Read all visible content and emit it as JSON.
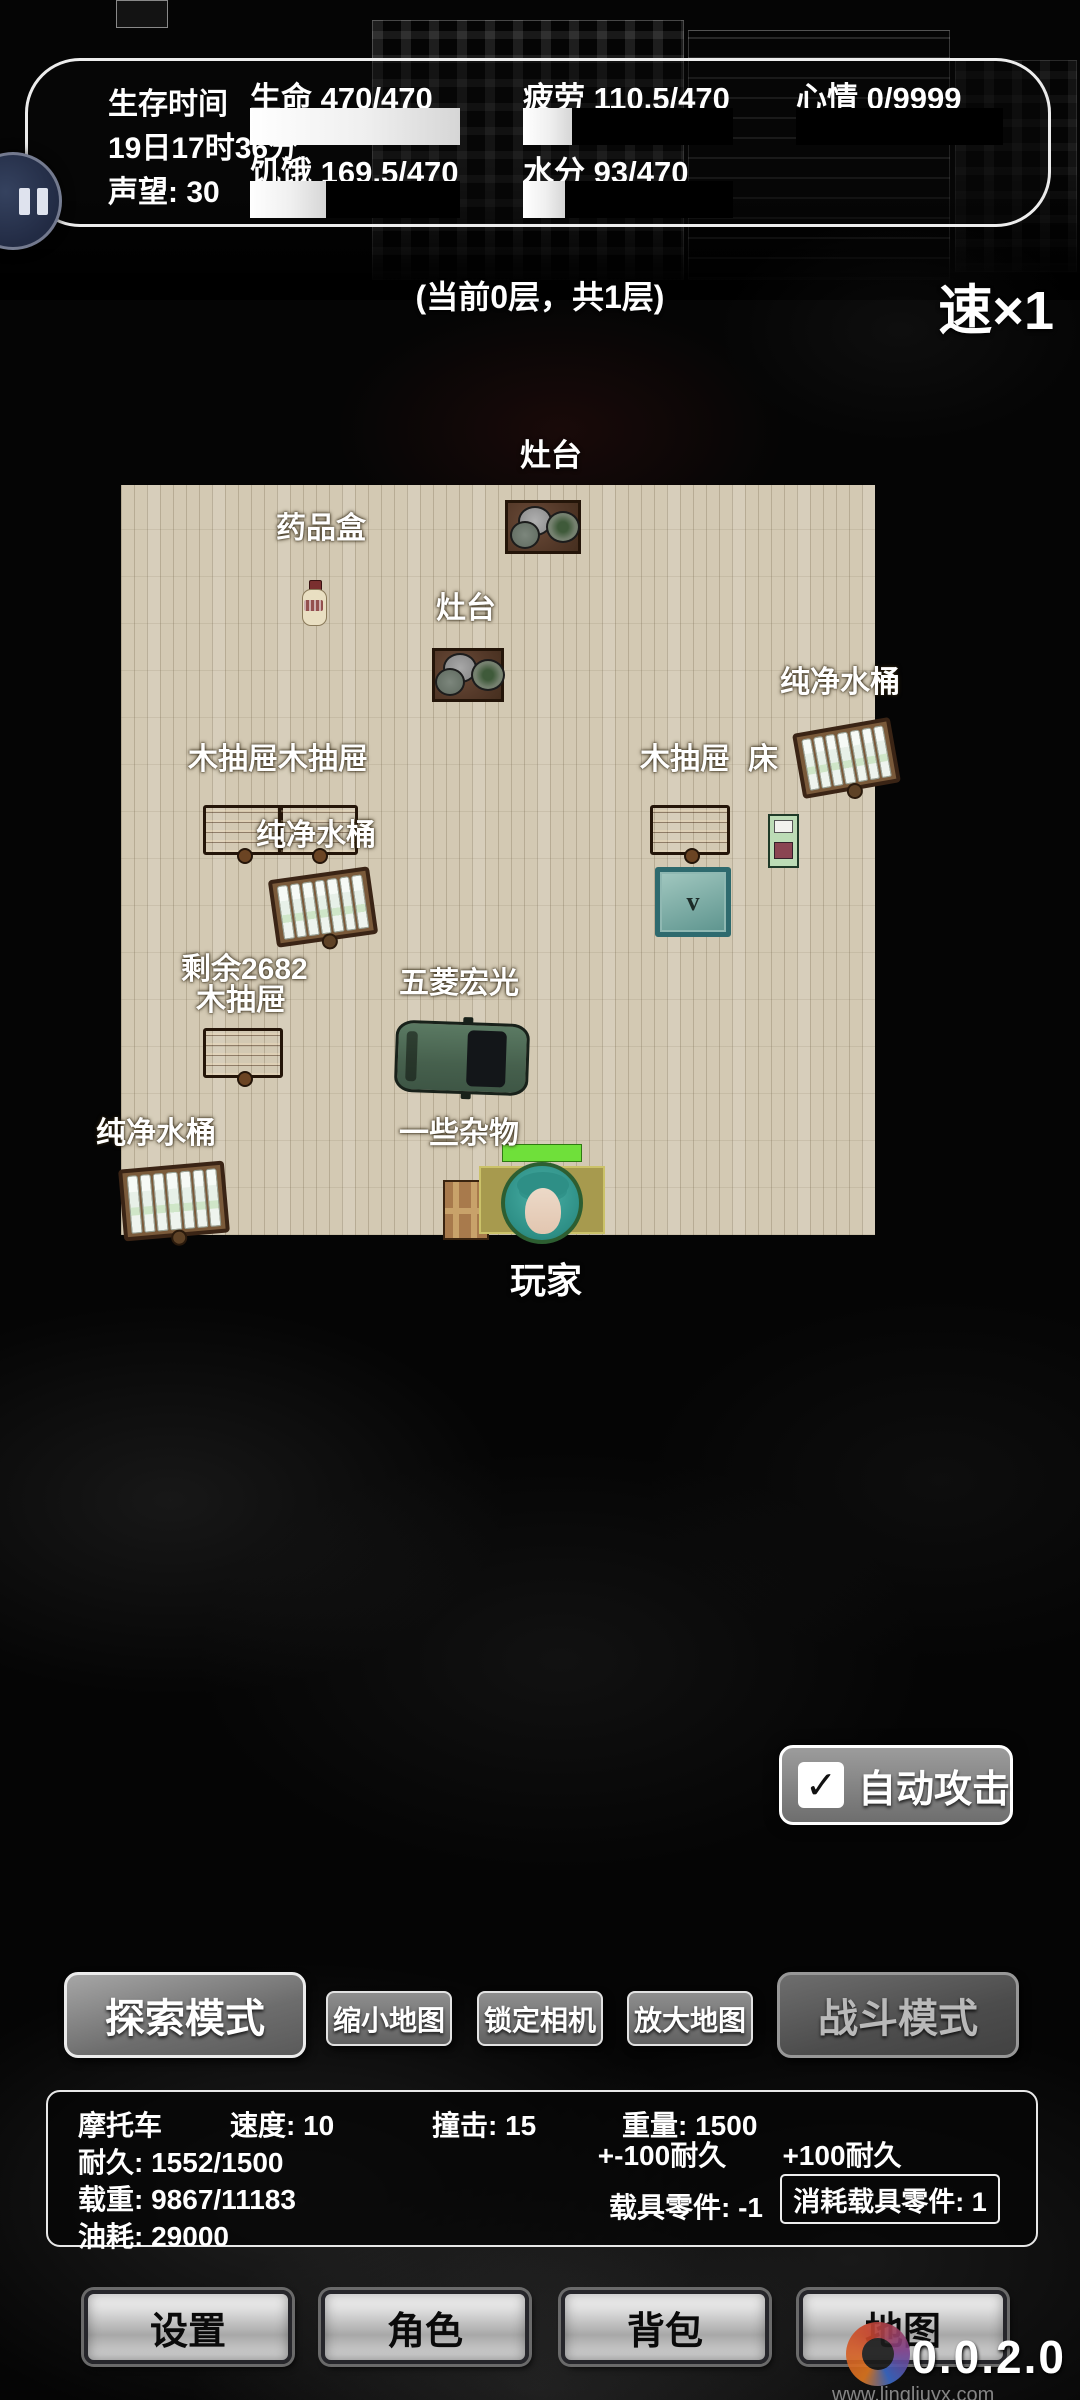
{
  "status_bar": {
    "survival_time_label": "生存时间",
    "survival_time_value": "19日17时36分",
    "reputation": "声望: 30",
    "stats": [
      {
        "name": "health",
        "label": "生命",
        "value": "470/470",
        "pct": 100
      },
      {
        "name": "hunger",
        "label": "饥饿",
        "value": "169.5/470",
        "pct": 36
      },
      {
        "name": "fatigue",
        "label": "疲劳",
        "value": "110.5/470",
        "pct": 23.5
      },
      {
        "name": "water",
        "label": "水分",
        "value": "93/470",
        "pct": 20
      },
      {
        "name": "mood",
        "label": "心情",
        "value": "0/9999",
        "pct": 0
      }
    ]
  },
  "hud": {
    "floor_info": "(当前0层，共1层)",
    "speed": "速×1"
  },
  "map": {
    "labels": [
      {
        "id": "stove-top",
        "text": "灶台"
      },
      {
        "id": "medicine-box",
        "text": "药品盒"
      },
      {
        "id": "stove-mid",
        "text": "灶台"
      },
      {
        "id": "water-barrel-right",
        "text": "纯净水桶"
      },
      {
        "id": "wood-drawer-double",
        "text": "木抽屉木抽屉"
      },
      {
        "id": "wood-drawer-right",
        "text": "木抽屉"
      },
      {
        "id": "bed",
        "text": "床"
      },
      {
        "id": "water-barrel-midleft",
        "text": "纯净水桶"
      },
      {
        "id": "remaining-count",
        "text": "剩余2682"
      },
      {
        "id": "wood-drawer-left",
        "text": "木抽屉"
      },
      {
        "id": "vehicle-wuling",
        "text": "五菱宏光"
      },
      {
        "id": "water-barrel-bottom",
        "text": "纯净水桶"
      },
      {
        "id": "misc-items",
        "text": "一些杂物"
      },
      {
        "id": "player",
        "text": "玩家"
      }
    ],
    "chest_glyph": "v",
    "colors": {
      "floor": "#d3c9b3",
      "health_bar": "#6fe03a"
    }
  },
  "auto_attack": {
    "label": "自动攻击",
    "checked": true,
    "checkmark": "✓"
  },
  "mode_buttons": {
    "explore": "探索模式",
    "shrink_map": "缩小地图",
    "lock_camera": "锁定相机",
    "enlarge_map": "放大地图",
    "battle": "战斗模式"
  },
  "vehicle_panel": {
    "name": "摩托车",
    "speed": "速度: 10",
    "impact": "撞击: 15",
    "weight": "重量: 1500",
    "durability": "耐久: 1552/1500",
    "load": "载重: 9867/11183",
    "fuel": "油耗: 29000",
    "repair_minus": "+-100耐久",
    "repair_plus": "+100耐久",
    "parts": "载具零件: -1",
    "consume_parts": "消耗载具零件: 1"
  },
  "nav": {
    "items": [
      {
        "id": "settings",
        "label": "设置"
      },
      {
        "id": "character",
        "label": "角色"
      },
      {
        "id": "backpack",
        "label": "背包"
      },
      {
        "id": "world-map",
        "label": "地图"
      }
    ]
  },
  "version": "0.0.2.0",
  "watermark": {
    "url": "www.lingliuyx.com"
  }
}
